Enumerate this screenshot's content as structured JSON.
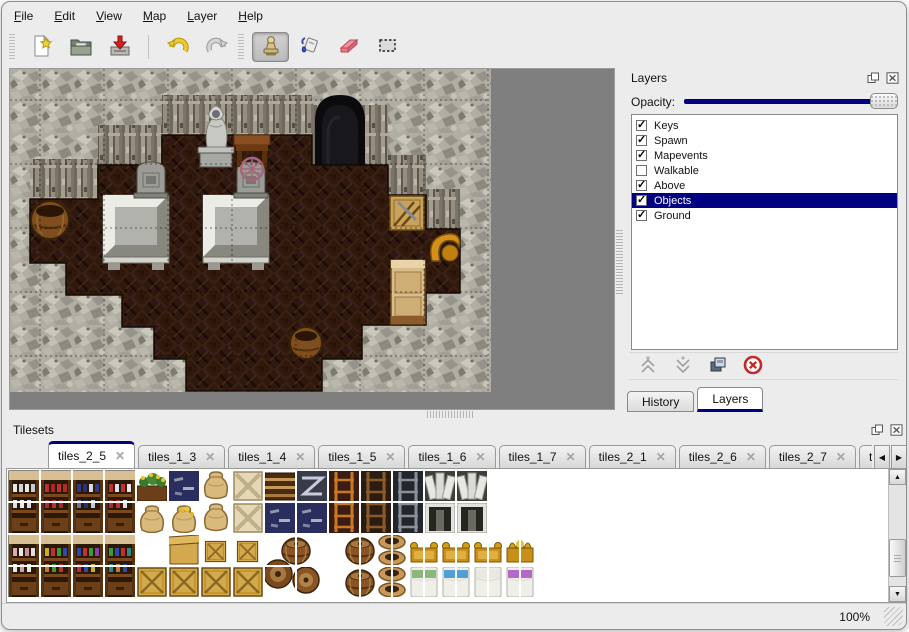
{
  "window": {
    "accent_color": "#000080",
    "background_color": "#ececec"
  },
  "menu": {
    "items": [
      {
        "label": "File"
      },
      {
        "label": "Edit"
      },
      {
        "label": "View"
      },
      {
        "label": "Map"
      },
      {
        "label": "Layer"
      },
      {
        "label": "Help"
      }
    ]
  },
  "toolbar": {
    "groups": [
      {
        "buttons": [
          {
            "icon": "new-file-icon"
          },
          {
            "icon": "open-folder-icon"
          },
          {
            "icon": "save-icon"
          }
        ]
      },
      {
        "buttons": [
          {
            "icon": "undo-icon"
          },
          {
            "icon": "redo-icon"
          }
        ]
      },
      {
        "buttons": [
          {
            "icon": "stamp-tool-icon",
            "active": true
          },
          {
            "icon": "fill-tool-icon"
          },
          {
            "icon": "eraser-tool-icon"
          },
          {
            "icon": "select-tool-icon"
          }
        ]
      }
    ]
  },
  "layers_panel": {
    "title": "Layers",
    "float_icon": "float-icon",
    "close_icon": "close-icon",
    "opacity_label": "Opacity:",
    "opacity_percent": 100,
    "layers": [
      {
        "name": "Keys",
        "checked": true,
        "selected": false
      },
      {
        "name": "Spawn",
        "checked": true,
        "selected": false
      },
      {
        "name": "Mapevents",
        "checked": true,
        "selected": false
      },
      {
        "name": "Walkable",
        "checked": false,
        "selected": false
      },
      {
        "name": "Above",
        "checked": true,
        "selected": false
      },
      {
        "name": "Objects",
        "checked": true,
        "selected": true
      },
      {
        "name": "Ground",
        "checked": true,
        "selected": false
      }
    ],
    "action_buttons": [
      {
        "icon": "move-up-icon"
      },
      {
        "icon": "move-down-icon"
      },
      {
        "icon": "duplicate-icon"
      },
      {
        "icon": "delete-icon"
      }
    ],
    "dock_tabs": [
      {
        "label": "History",
        "active": false
      },
      {
        "label": "Layers",
        "active": true
      }
    ]
  },
  "tilesets_panel": {
    "title": "Tilesets",
    "float_icon": "float-icon",
    "close_icon": "close-icon",
    "tabs": [
      {
        "label": "tiles_2_5",
        "active": true
      },
      {
        "label": "tiles_1_3",
        "active": false
      },
      {
        "label": "tiles_1_4",
        "active": false
      },
      {
        "label": "tiles_1_5",
        "active": false
      },
      {
        "label": "tiles_1_6",
        "active": false
      },
      {
        "label": "tiles_1_7",
        "active": false
      },
      {
        "label": "tiles_2_1",
        "active": false
      },
      {
        "label": "tiles_2_6",
        "active": false
      },
      {
        "label": "tiles_2_7",
        "active": false
      },
      {
        "label": "tiles_",
        "active": false
      }
    ],
    "scroll_left_icon": "tab-scroll-left-icon",
    "scroll_right_icon": "tab-scroll-right-icon"
  },
  "statusbar": {
    "zoom": "100%"
  }
}
